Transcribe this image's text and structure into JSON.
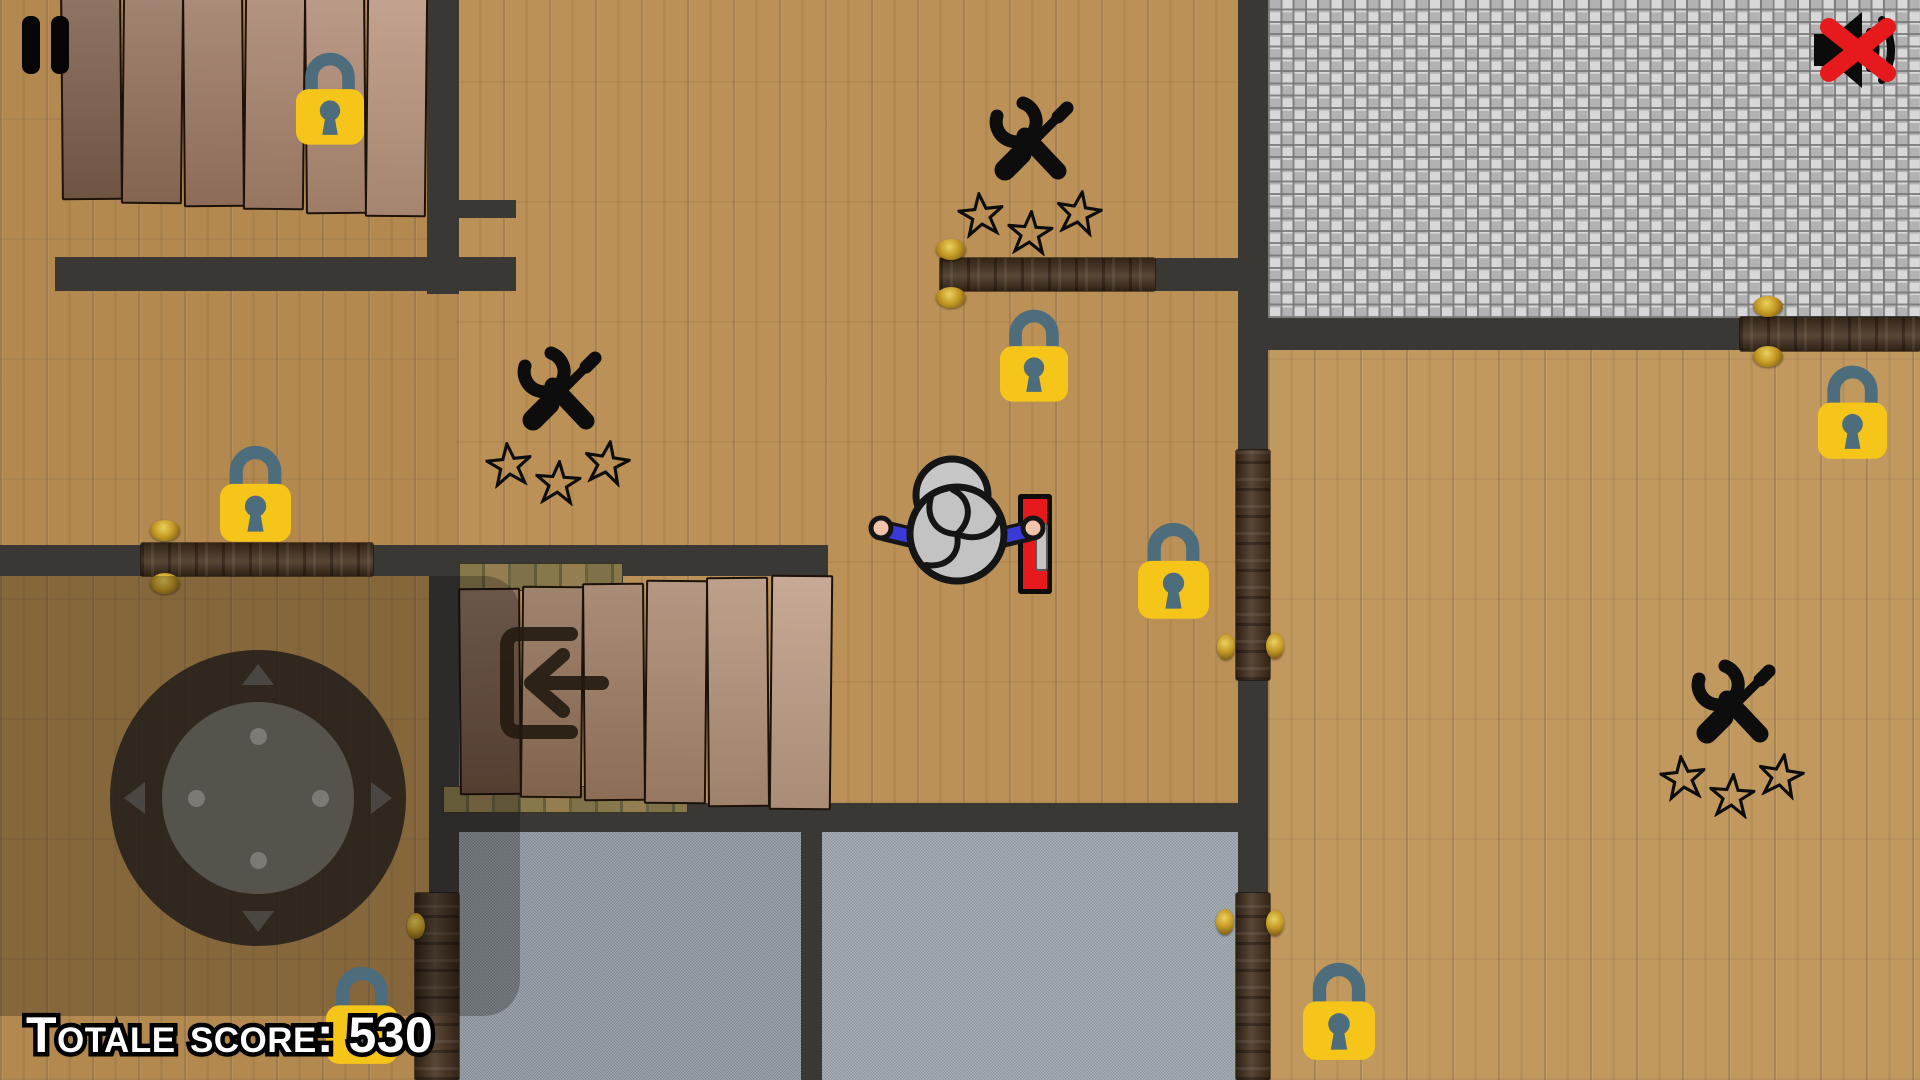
{
  "hud": {
    "pause": {
      "icon": "pause-icon"
    },
    "mute": {
      "icon": "muted-audio-icon",
      "state": "muted"
    },
    "score": {
      "label": "Totale score:",
      "value": "530",
      "text": "Totale score: 530"
    }
  },
  "palette": {
    "wall": "#3a3835",
    "wood_left": "#b3894f",
    "wood_mid": "#bb9157",
    "wood_right": "#c1995f",
    "tile_light": "#d8d8d8",
    "tile_dark": "#b2b2b2",
    "concrete_left": "#8f979d",
    "concrete_right": "#9ca4ab",
    "door_wood": "#46321f",
    "hinge_gold": "#c49a24",
    "lock_body": "#f6c51a",
    "lock_shackle": "#4e6d7c",
    "red_door": "#e6191c",
    "icon_black": "#0d0d0d",
    "player_arm_blue": "#3a3ad6",
    "player_hand": "#f2c3ab",
    "score_fill": "#ffffff",
    "score_outline": "#000000"
  },
  "game": {
    "floors": [
      {
        "id": "left-column-room",
        "x": 0,
        "y": 0,
        "w": 459,
        "h": 1080,
        "t": "wood",
        "tone": "#b3894f"
      },
      {
        "id": "middle-room",
        "x": 457,
        "y": 0,
        "w": 781,
        "h": 803,
        "t": "wood",
        "tone": "#bb9157"
      },
      {
        "id": "tile-room",
        "x": 1268,
        "y": 0,
        "w": 652,
        "h": 318,
        "t": "tile",
        "tone": "#c9c9c9"
      },
      {
        "id": "right-room",
        "x": 1268,
        "y": 318,
        "w": 652,
        "h": 762,
        "t": "wood",
        "tone": "#c1995f"
      },
      {
        "id": "concrete-room-left",
        "x": 459,
        "y": 832,
        "w": 342,
        "h": 248,
        "t": "concrete",
        "tone": "#8f979d"
      },
      {
        "id": "concrete-room-right",
        "x": 822,
        "y": 832,
        "w": 416,
        "h": 248,
        "t": "concrete",
        "tone": "#9ca4ab"
      }
    ],
    "walls": [
      [
        427,
        0,
        32,
        294
      ],
      [
        55,
        257,
        461,
        34
      ],
      [
        459,
        200,
        57,
        18
      ],
      [
        0,
        545,
        828,
        31
      ],
      [
        429,
        576,
        30,
        317
      ],
      [
        459,
        803,
        779,
        29
      ],
      [
        801,
        832,
        21,
        248
      ],
      [
        1238,
        0,
        30,
        450
      ],
      [
        1238,
        680,
        30,
        213
      ],
      [
        1268,
        318,
        472,
        32
      ],
      [
        1155,
        258,
        100,
        33
      ]
    ],
    "stones": [
      [
        459,
        563,
        162,
        26
      ],
      [
        443,
        786,
        243,
        25
      ]
    ],
    "stairs": [
      {
        "id": "top-left-stairs",
        "x": [
          61,
          122,
          183,
          244,
          305,
          366
        ],
        "y": -8,
        "w": 57,
        "bottoms": [
          196,
          200,
          203,
          206,
          210,
          213
        ],
        "colors": [
          "#7d5e4a",
          "#92705a",
          "#9d7963",
          "#a7836c",
          "#b08b74",
          "#b9947d"
        ]
      },
      {
        "id": "center-stairs",
        "x": [
          459,
          521,
          583,
          645,
          707,
          770
        ],
        "w": 58,
        "tops": [
          588,
          586,
          583,
          580,
          577,
          575
        ],
        "bottoms": [
          791,
          794,
          797,
          800,
          803,
          806
        ],
        "colors": [
          "#7b5b47",
          "#8f6f56",
          "#9c7a61",
          "#a8866e",
          "#b29178",
          "#bd9c84"
        ]
      }
    ],
    "doors": [
      {
        "id": "left-door",
        "o": "h",
        "x": 141,
        "y": 543,
        "w": 232,
        "h": 33,
        "hinges": [
          [
            150,
            520
          ],
          [
            150,
            573
          ]
        ]
      },
      {
        "id": "top-middle-door",
        "o": "h",
        "x": 940,
        "y": 258,
        "w": 215,
        "h": 33,
        "hinges": [
          [
            936,
            239
          ],
          [
            936,
            287
          ]
        ]
      },
      {
        "id": "top-right-door",
        "o": "h",
        "x": 1740,
        "y": 317,
        "w": 180,
        "h": 34,
        "hinges": [
          [
            1753,
            296
          ],
          [
            1753,
            346
          ]
        ]
      },
      {
        "id": "center-door",
        "o": "v",
        "x": 1236,
        "y": 450,
        "w": 34,
        "h": 230,
        "hinges": [
          [
            1217,
            634
          ],
          [
            1266,
            633
          ]
        ]
      },
      {
        "id": "bottom-right-door",
        "o": "v",
        "x": 1236,
        "y": 893,
        "w": 34,
        "h": 187,
        "hinges": [
          [
            1216,
            909
          ],
          [
            1266,
            910
          ]
        ]
      },
      {
        "id": "bottom-left-door",
        "o": "v",
        "x": 415,
        "y": 893,
        "w": 44,
        "h": 187,
        "hinges": [
          [
            407,
            913
          ]
        ]
      }
    ],
    "red_door": {
      "x": 1018,
      "y": 494,
      "w": 34,
      "h": 100
    },
    "locks": [
      [
        295,
        44,
        70
      ],
      [
        219,
        437,
        73
      ],
      [
        999,
        301,
        70
      ],
      [
        1137,
        514,
        73
      ],
      [
        1817,
        357,
        71
      ],
      [
        1302,
        954,
        74
      ],
      [
        325,
        958,
        74
      ]
    ],
    "repair_stations": [
      {
        "x": 958,
        "y": 90
      },
      {
        "x": 486,
        "y": 340
      },
      {
        "x": 1660,
        "y": 653
      }
    ],
    "stars_per_station": 3,
    "exit_sign": {
      "x": 485,
      "y": 618,
      "size": 130
    },
    "shadow": {
      "x": -60,
      "y": 576,
      "w": 580,
      "h": 440,
      "radius": 36
    },
    "joystick": {
      "cx": 258,
      "cy": 798,
      "outer_r": 148,
      "inner_r": 96,
      "dot_r": 8.5,
      "dot_offset": 62
    },
    "player": {
      "x": 857,
      "y": 450,
      "w": 200,
      "h": 155
    }
  }
}
